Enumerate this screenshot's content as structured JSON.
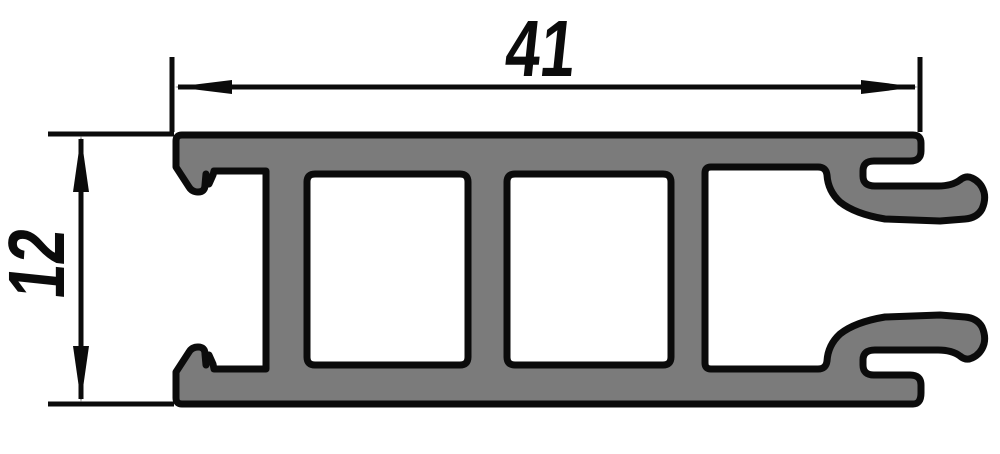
{
  "drawing": {
    "dimensions": {
      "width": {
        "value": "41",
        "orientation": "horizontal"
      },
      "height": {
        "value": "12",
        "orientation": "vertical"
      }
    },
    "colors": {
      "profile_fill": "#7b7b7b",
      "outline": "#0b0b0b",
      "background": "#ffffff"
    }
  }
}
